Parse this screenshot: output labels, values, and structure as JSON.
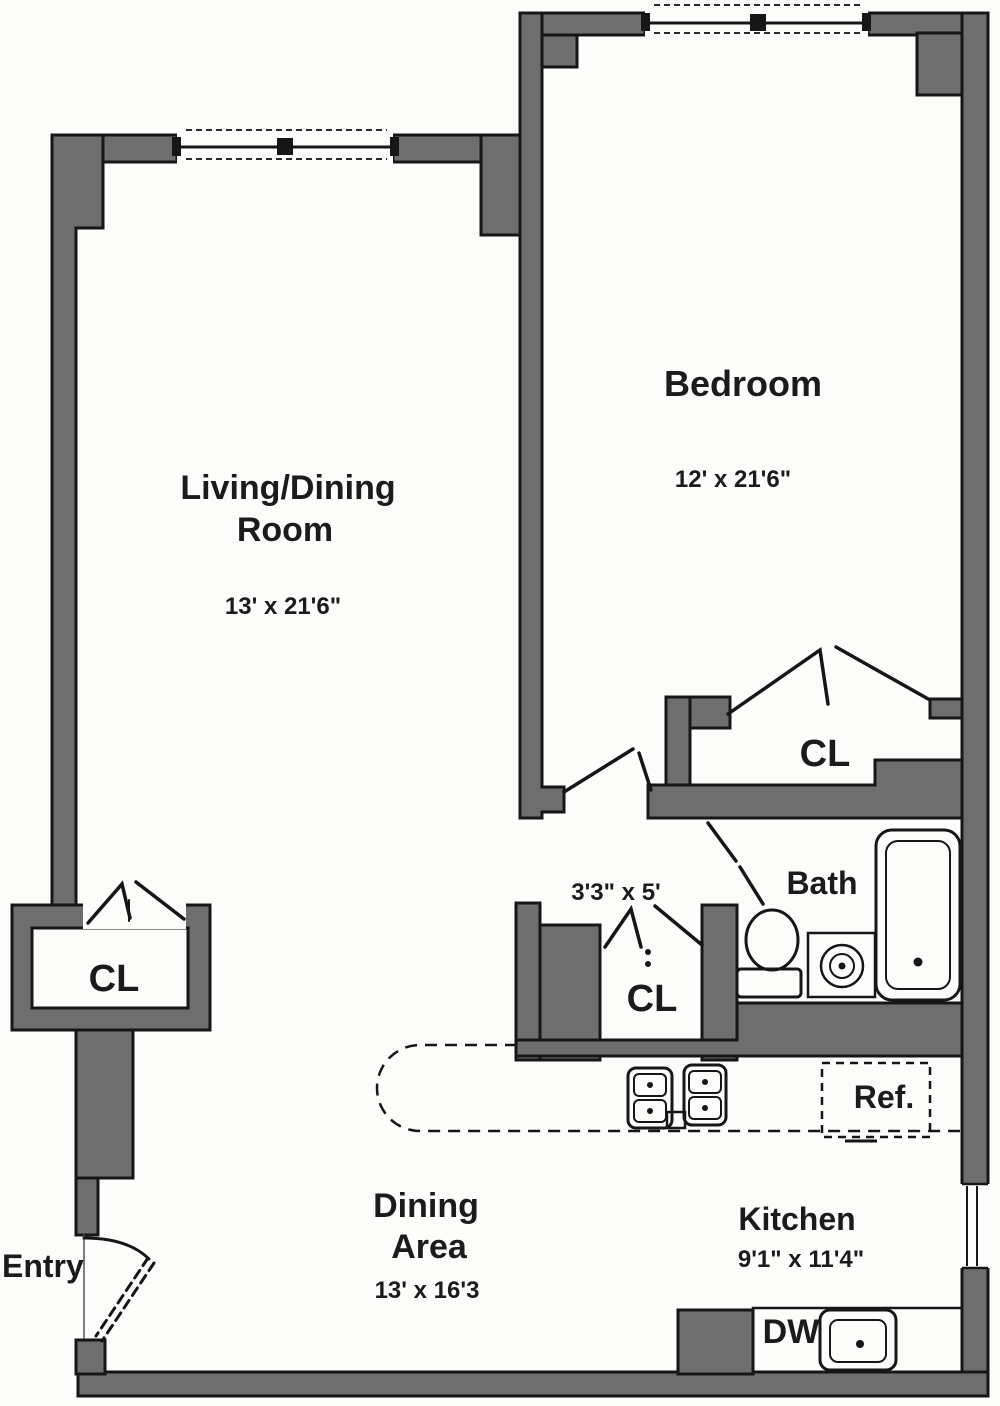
{
  "plan": {
    "type": "apartment-floor-plan",
    "colors": {
      "wall_fill": "#6e6e6e",
      "wall_outline": "#161616",
      "line": "#161616",
      "background": "#fcfcfb"
    },
    "rooms": {
      "living_dining": {
        "label_line1": "Living/Dining",
        "label_line2": "Room",
        "dimensions": "13' x 21'6\""
      },
      "bedroom": {
        "label": "Bedroom",
        "dimensions": "12' x 21'6\""
      },
      "bedroom_closet": {
        "label": "CL"
      },
      "bath": {
        "label": "Bath"
      },
      "hall_closet": {
        "label": "CL",
        "dimensions": "3'3\" x 5'"
      },
      "entry_closet": {
        "label": "CL"
      },
      "entry": {
        "label": "Entry"
      },
      "dining_area": {
        "label_line1": "Dining",
        "label_line2": "Area",
        "dimensions": "13' x 16'3"
      },
      "kitchen": {
        "label": "Kitchen",
        "dimensions": "9'1\" x 11'4\""
      }
    },
    "fixtures": {
      "refrigerator": {
        "label": "Ref."
      },
      "dishwasher": {
        "label": "DW"
      }
    }
  }
}
